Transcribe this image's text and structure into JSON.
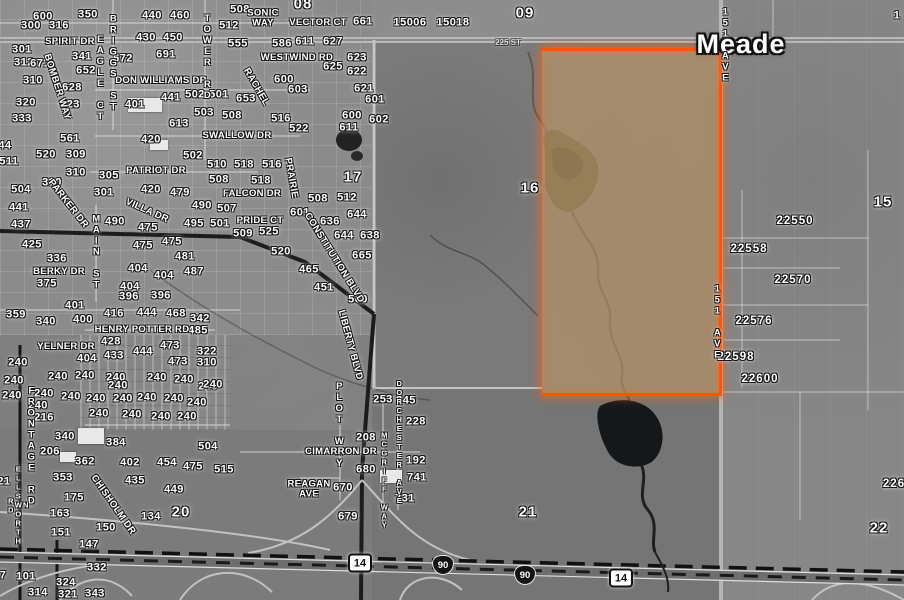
{
  "map": {
    "county": {
      "name": "Meade",
      "x": 741,
      "y": 45
    },
    "road_tag": {
      "t": "225 ST",
      "x": 508,
      "y": 43
    },
    "selected_parcel": {
      "section": "16",
      "fill_color": "#bc9768",
      "outline_color": "#ff5207"
    },
    "colors": {
      "highlight_orange": "#ff5207",
      "parcel_tan": "#bc9768",
      "label_white": "#ffffff",
      "halo_black": "#161616"
    },
    "labels": {
      "sections": [
        [
          "09",
          525,
          13
        ],
        [
          "08",
          303,
          4
        ],
        [
          "15",
          883,
          202
        ],
        [
          "16",
          530,
          188
        ],
        [
          "17",
          353,
          177
        ],
        [
          "20",
          181,
          512
        ],
        [
          "21",
          528,
          512
        ],
        [
          "22",
          879,
          528
        ]
      ],
      "parcels": [
        [
          "22550",
          795,
          222
        ],
        [
          "22558",
          749,
          250
        ],
        [
          "22570",
          793,
          281
        ],
        [
          "22576",
          754,
          322
        ],
        [
          "22598",
          736,
          358
        ],
        [
          "22600",
          760,
          380
        ],
        [
          "226",
          894,
          485
        ]
      ],
      "addresses": [
        [
          "600",
          43,
          17
        ],
        [
          "350",
          88,
          15
        ],
        [
          "440",
          152,
          16
        ],
        [
          "460",
          180,
          16
        ],
        [
          "300",
          31,
          26
        ],
        [
          "316",
          59,
          26
        ],
        [
          "508",
          240,
          10
        ],
        [
          "512",
          229,
          26
        ],
        [
          "430",
          146,
          38
        ],
        [
          "450",
          173,
          38
        ],
        [
          "301",
          22,
          50
        ],
        [
          "341",
          82,
          57
        ],
        [
          "672",
          123,
          59
        ],
        [
          "691",
          166,
          55
        ],
        [
          "555",
          238,
          44
        ],
        [
          "586",
          282,
          44
        ],
        [
          "312",
          24,
          63
        ],
        [
          "671",
          40,
          64
        ],
        [
          "652",
          86,
          71
        ],
        [
          "310",
          33,
          81
        ],
        [
          "628",
          72,
          88
        ],
        [
          "600",
          284,
          80
        ],
        [
          "603",
          298,
          90
        ],
        [
          "320",
          26,
          103
        ],
        [
          "623",
          70,
          105
        ],
        [
          "333",
          22,
          119
        ],
        [
          "561",
          70,
          139
        ],
        [
          "401",
          135,
          105
        ],
        [
          "441",
          171,
          98
        ],
        [
          "502",
          195,
          95
        ],
        [
          "501",
          219,
          95
        ],
        [
          "653",
          246,
          99
        ],
        [
          "503",
          204,
          113
        ],
        [
          "508",
          232,
          116
        ],
        [
          "516",
          281,
          119
        ],
        [
          "522",
          299,
          129
        ],
        [
          "613",
          179,
          124
        ],
        [
          "420",
          151,
          140
        ],
        [
          "661",
          363,
          22
        ],
        [
          "15006",
          410,
          23
        ],
        [
          "15018",
          453,
          23
        ],
        [
          "611",
          305,
          42
        ],
        [
          "627",
          333,
          42
        ],
        [
          "623",
          357,
          58
        ],
        [
          "625",
          333,
          67
        ],
        [
          "622",
          357,
          72
        ],
        [
          "621",
          364,
          89
        ],
        [
          "601",
          375,
          100
        ],
        [
          "600",
          352,
          116
        ],
        [
          "611",
          349,
          128
        ],
        [
          "602",
          379,
          120
        ],
        [
          "512",
          347,
          198
        ],
        [
          "508",
          318,
          199
        ],
        [
          "601",
          300,
          213
        ],
        [
          "636",
          330,
          222
        ],
        [
          "644",
          357,
          215
        ],
        [
          "644",
          344,
          236
        ],
        [
          "638",
          370,
          236
        ],
        [
          "665",
          362,
          256
        ],
        [
          "465",
          309,
          270
        ],
        [
          "451",
          324,
          288
        ],
        [
          "560",
          358,
          300
        ],
        [
          "520",
          46,
          155
        ],
        [
          "309",
          76,
          155
        ],
        [
          "511",
          9,
          162
        ],
        [
          "310",
          76,
          173
        ],
        [
          "310",
          52,
          183
        ],
        [
          "305",
          109,
          176
        ],
        [
          "502",
          193,
          156
        ],
        [
          "510",
          217,
          165
        ],
        [
          "518",
          244,
          165
        ],
        [
          "516",
          272,
          165
        ],
        [
          "508",
          219,
          180
        ],
        [
          "518",
          261,
          181
        ],
        [
          "504",
          21,
          190
        ],
        [
          "301",
          104,
          193
        ],
        [
          "420",
          151,
          190
        ],
        [
          "479",
          180,
          193
        ],
        [
          "490",
          202,
          206
        ],
        [
          "507",
          227,
          209
        ],
        [
          "441",
          19,
          208
        ],
        [
          "437",
          21,
          225
        ],
        [
          "495",
          194,
          224
        ],
        [
          "501",
          220,
          224
        ],
        [
          "509",
          243,
          234
        ],
        [
          "525",
          269,
          232
        ],
        [
          "520",
          281,
          252
        ],
        [
          "490",
          115,
          222
        ],
        [
          "475",
          148,
          228
        ],
        [
          "425",
          32,
          245
        ],
        [
          "475",
          143,
          246
        ],
        [
          "475",
          172,
          242
        ],
        [
          "481",
          185,
          257
        ],
        [
          "336",
          57,
          259
        ],
        [
          "487",
          194,
          272
        ],
        [
          "404",
          138,
          269
        ],
        [
          "404",
          164,
          276
        ],
        [
          "375",
          47,
          284
        ],
        [
          "404",
          130,
          287
        ],
        [
          "396",
          129,
          297
        ],
        [
          "396",
          161,
          296
        ],
        [
          "359",
          16,
          315
        ],
        [
          "340",
          46,
          322
        ],
        [
          "401",
          75,
          306
        ],
        [
          "400",
          83,
          320
        ],
        [
          "416",
          114,
          314
        ],
        [
          "444",
          147,
          313
        ],
        [
          "468",
          176,
          314
        ],
        [
          "342",
          200,
          319
        ],
        [
          "485",
          198,
          331
        ],
        [
          "428",
          111,
          342
        ],
        [
          "473",
          170,
          346
        ],
        [
          "322",
          207,
          352
        ],
        [
          "433",
          114,
          356
        ],
        [
          "444",
          143,
          352
        ],
        [
          "404",
          87,
          359
        ],
        [
          "473",
          178,
          362
        ],
        [
          "310",
          207,
          363
        ],
        [
          "216",
          44,
          418
        ],
        [
          "340",
          65,
          437
        ],
        [
          "384",
          116,
          443
        ],
        [
          "504",
          208,
          447
        ],
        [
          "240",
          18,
          363
        ],
        [
          "240",
          14,
          381
        ],
        [
          "240",
          58,
          377
        ],
        [
          "240",
          85,
          376
        ],
        [
          "240",
          12,
          396
        ],
        [
          "240",
          44,
          394
        ],
        [
          "240",
          71,
          397
        ],
        [
          "240",
          116,
          378
        ],
        [
          "240",
          118,
          386
        ],
        [
          "240",
          157,
          378
        ],
        [
          "240",
          184,
          380
        ],
        [
          "240",
          208,
          387
        ],
        [
          "240",
          38,
          406
        ],
        [
          "240",
          96,
          399
        ],
        [
          "240",
          123,
          399
        ],
        [
          "240",
          147,
          398
        ],
        [
          "240",
          174,
          399
        ],
        [
          "240",
          197,
          403
        ],
        [
          "240",
          99,
          414
        ],
        [
          "240",
          132,
          415
        ],
        [
          "240",
          161,
          417
        ],
        [
          "240",
          187,
          417
        ],
        [
          "240",
          213,
          385
        ],
        [
          "253",
          383,
          400
        ],
        [
          "245",
          406,
          401
        ],
        [
          "228",
          416,
          422
        ],
        [
          "192",
          416,
          461
        ],
        [
          "741",
          417,
          478
        ],
        [
          "731",
          405,
          499
        ],
        [
          "208",
          366,
          438
        ],
        [
          "680",
          366,
          470
        ],
        [
          "670",
          343,
          488
        ],
        [
          "679",
          348,
          517
        ],
        [
          "206",
          50,
          452
        ],
        [
          "362",
          85,
          462
        ],
        [
          "402",
          130,
          463
        ],
        [
          "454",
          167,
          463
        ],
        [
          "475",
          193,
          467
        ],
        [
          "515",
          224,
          470
        ],
        [
          "353",
          63,
          478
        ],
        [
          "435",
          135,
          481
        ],
        [
          "449",
          174,
          490
        ],
        [
          "175",
          74,
          498
        ],
        [
          "163",
          60,
          514
        ],
        [
          "134",
          151,
          517
        ],
        [
          "151",
          61,
          533
        ],
        [
          "150",
          106,
          528
        ],
        [
          "147",
          89,
          545
        ],
        [
          "101",
          26,
          577
        ],
        [
          "332",
          97,
          568
        ],
        [
          "324",
          66,
          583
        ],
        [
          "314",
          38,
          593
        ],
        [
          "321",
          68,
          595
        ],
        [
          "343",
          95,
          594
        ]
      ],
      "fragments": [
        [
          "44",
          5,
          146
        ],
        [
          "21",
          4,
          482
        ],
        [
          "7",
          3,
          576
        ],
        [
          "1",
          897,
          16
        ]
      ],
      "streets": [
        {
          "t": "SONIC\nWAY",
          "x": 263,
          "y": 18,
          "m": "h"
        },
        {
          "t": "VECTOR CT",
          "x": 318,
          "y": 23,
          "m": "h"
        },
        {
          "t": "SPIRIT DR",
          "x": 70,
          "y": 42,
          "m": "h"
        },
        {
          "t": "WESTWIND RD",
          "x": 297,
          "y": 58,
          "m": "h"
        },
        {
          "t": "DON WILLIAMS DR",
          "x": 161,
          "y": 81,
          "m": "h"
        },
        {
          "t": "TOWER RD",
          "x": 207,
          "y": 57,
          "m": "v"
        },
        {
          "t": "BRIGGS ST",
          "x": 113,
          "y": 63,
          "m": "v"
        },
        {
          "t": "EAGLE CT",
          "x": 100,
          "y": 78,
          "m": "v"
        },
        {
          "t": "BOMBER WAY",
          "x": 57,
          "y": 87,
          "m": "r",
          "r": 72
        },
        {
          "t": "RACHEL",
          "x": 256,
          "y": 87,
          "m": "r",
          "r": 60
        },
        {
          "t": "PRAIRIE",
          "x": 291,
          "y": 178,
          "m": "r",
          "r": 80
        },
        {
          "t": "SWALLOW DR",
          "x": 237,
          "y": 136,
          "m": "h"
        },
        {
          "t": "PATRIOT DR",
          "x": 156,
          "y": 171,
          "m": "h"
        },
        {
          "t": "PARKER DR",
          "x": 68,
          "y": 204,
          "m": "r",
          "r": 52
        },
        {
          "t": "VILLA DR",
          "x": 147,
          "y": 211,
          "m": "r",
          "r": 24
        },
        {
          "t": "FALCON DR",
          "x": 252,
          "y": 194,
          "m": "h"
        },
        {
          "t": "PRIDE CT",
          "x": 260,
          "y": 221,
          "m": "h"
        },
        {
          "t": "MAIN ST",
          "x": 96,
          "y": 252,
          "m": "v"
        },
        {
          "t": "BERKY DR",
          "x": 59,
          "y": 272,
          "m": "h"
        },
        {
          "t": "HENRY POTTER RD",
          "x": 142,
          "y": 330,
          "m": "h"
        },
        {
          "t": "YELNER DR",
          "x": 66,
          "y": 347,
          "m": "h"
        },
        {
          "t": "CONSTITUTION BLVD",
          "x": 334,
          "y": 258,
          "m": "r",
          "r": 58
        },
        {
          "t": "LIBERTY BLVD",
          "x": 350,
          "y": 345,
          "m": "r",
          "r": 75
        },
        {
          "t": "FRONTAGE RD",
          "x": 31,
          "y": 446,
          "m": "v"
        },
        {
          "t": "N ELLSWORTH RD",
          "x": 18,
          "y": 505,
          "m": "vs"
        },
        {
          "t": "CHISHOLM DR",
          "x": 113,
          "y": 505,
          "m": "r",
          "r": 55
        },
        {
          "t": "PLOT WAY",
          "x": 339,
          "y": 425,
          "m": "v"
        },
        {
          "t": "CIMARRON DR",
          "x": 341,
          "y": 452,
          "m": "h"
        },
        {
          "t": "DORCHESTER AVE",
          "x": 399,
          "y": 442,
          "m": "vs"
        },
        {
          "t": "MCGRIFF WAY",
          "x": 384,
          "y": 480,
          "m": "vs"
        },
        {
          "t": "REAGAN\nAVE",
          "x": 309,
          "y": 489,
          "m": "h"
        },
        {
          "t": "151 AVE",
          "x": 725,
          "y": 45,
          "m": "v"
        },
        {
          "t": "151 AVE",
          "x": 717,
          "y": 322,
          "m": "v"
        }
      ],
      "shields": [
        {
          "t": "14",
          "k": "state",
          "x": 360,
          "y": 563
        },
        {
          "t": "90",
          "k": "interstate",
          "x": 443,
          "y": 565
        },
        {
          "t": "90",
          "k": "interstate",
          "x": 525,
          "y": 575
        },
        {
          "t": "14",
          "k": "state",
          "x": 621,
          "y": 578
        }
      ]
    }
  }
}
